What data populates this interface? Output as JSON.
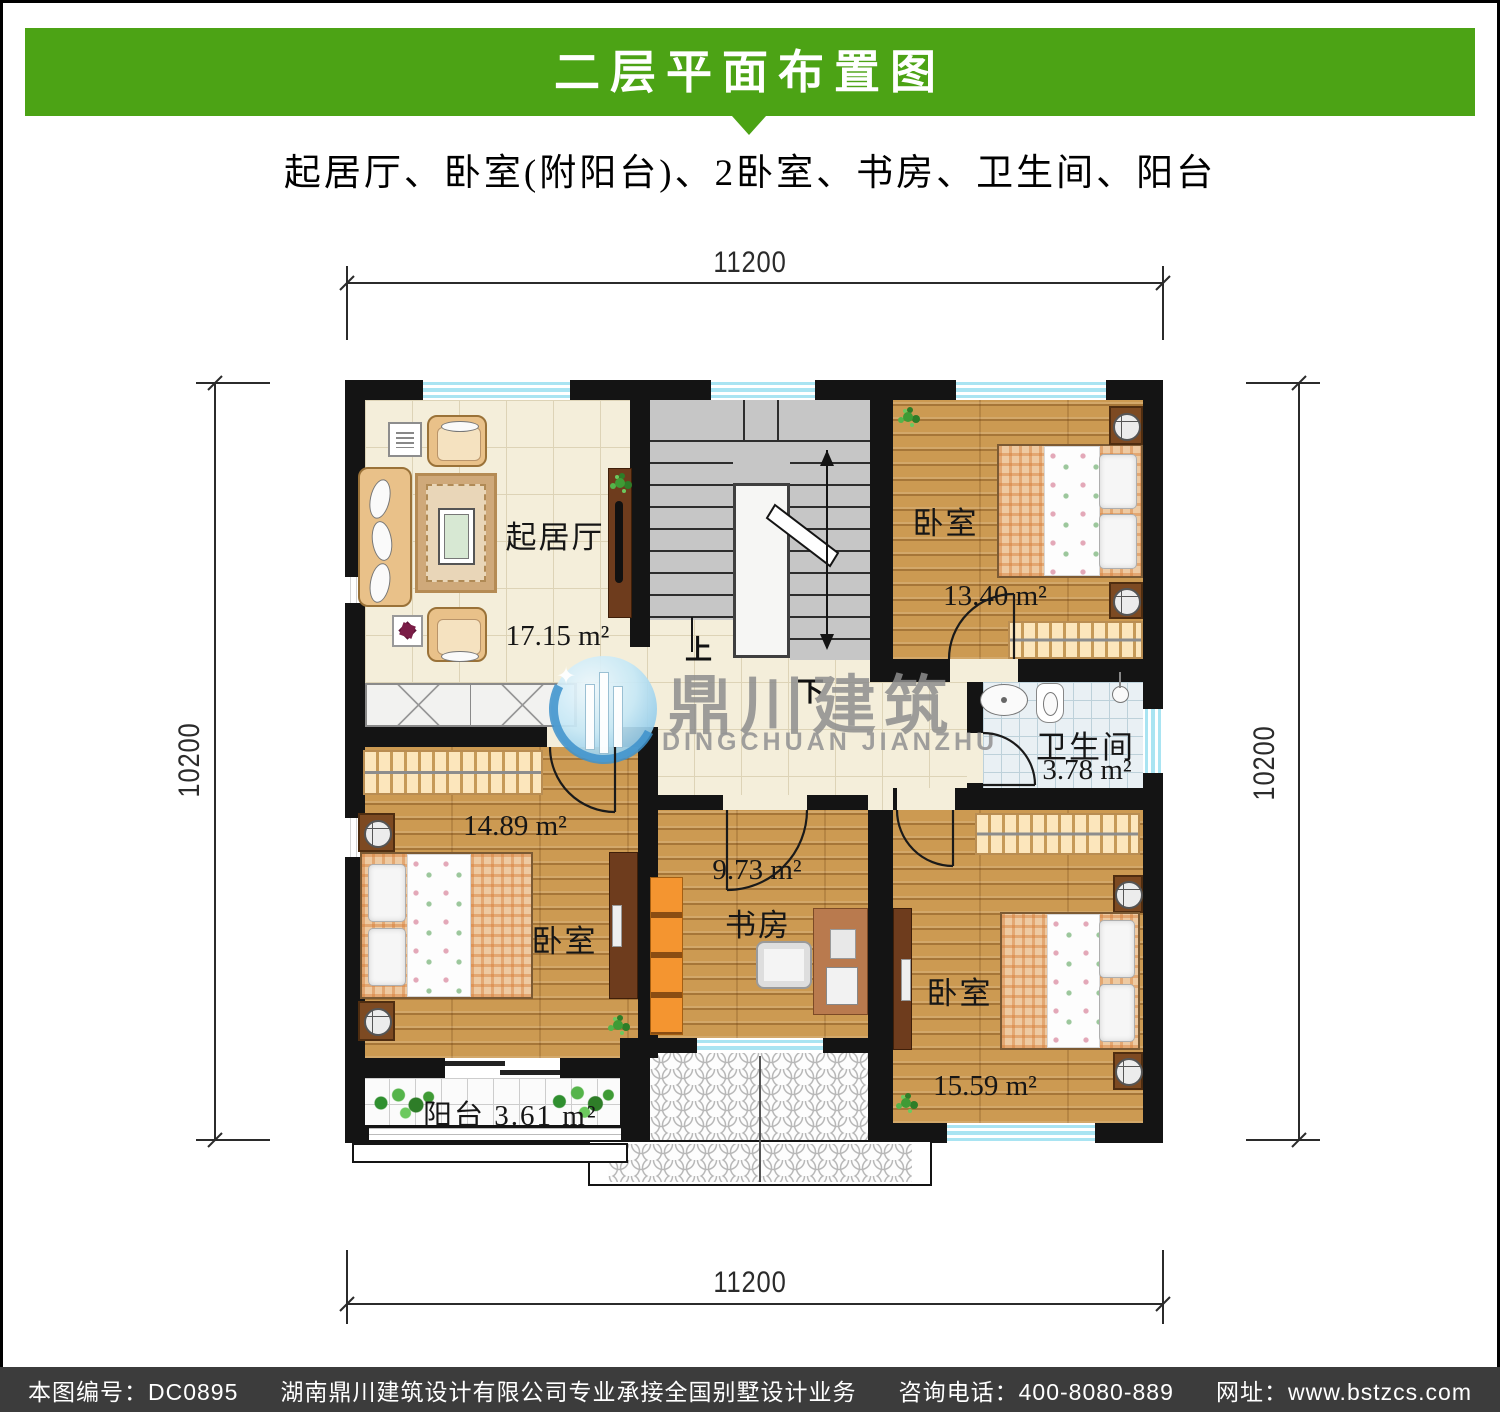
{
  "header": {
    "title": "二层平面布置图",
    "subtitle": "起居厅、卧室(附阳台)、2卧室、书房、卫生间、阳台"
  },
  "dimensions": {
    "top": "11200",
    "bottom": "11200",
    "left": "10200",
    "right": "10200"
  },
  "rooms": {
    "living_room": {
      "label": "起居厅",
      "area": "17.15 m²"
    },
    "bedroom_top_right": {
      "label": "卧室",
      "area": "13.40 m²"
    },
    "bathroom": {
      "label": "卫生间",
      "area": "3.78 m²"
    },
    "bedroom_left": {
      "label": "卧室",
      "area": "14.89 m²"
    },
    "study": {
      "label": "书房",
      "area": "9.73 m²"
    },
    "bedroom_bottom_right": {
      "label": "卧室",
      "area": "15.59 m²"
    },
    "balcony": {
      "label": "阳台",
      "area": "3.61 m²"
    }
  },
  "stairs": {
    "up_label": "上",
    "down_label": "下"
  },
  "watermark": {
    "brand_cn": "鼎川建筑",
    "brand_en": "DINGCHUAN JIANZHU",
    "spark": "✦"
  },
  "footer": {
    "drawing_no": "本图编号：DC0895",
    "company": "湖南鼎川建筑设计有限公司专业承接全国别墅设计业务",
    "phone": "咨询电话：400-8080-889",
    "website": "网址：www.bstzcs.com"
  },
  "colors": {
    "banner_green": "#4ca315",
    "footer_bg": "#3c3c3c",
    "wall": "#141414",
    "window_blue": "#a9e4f2",
    "wood_floor": "#cc9a52",
    "cream_tile": "#f4eeda",
    "stair_gray": "#c6c6c6",
    "bath_tile": "#e9f0f4",
    "bookshelf_orange": "#f49530",
    "watermark_gray": "#8e8e8e"
  }
}
